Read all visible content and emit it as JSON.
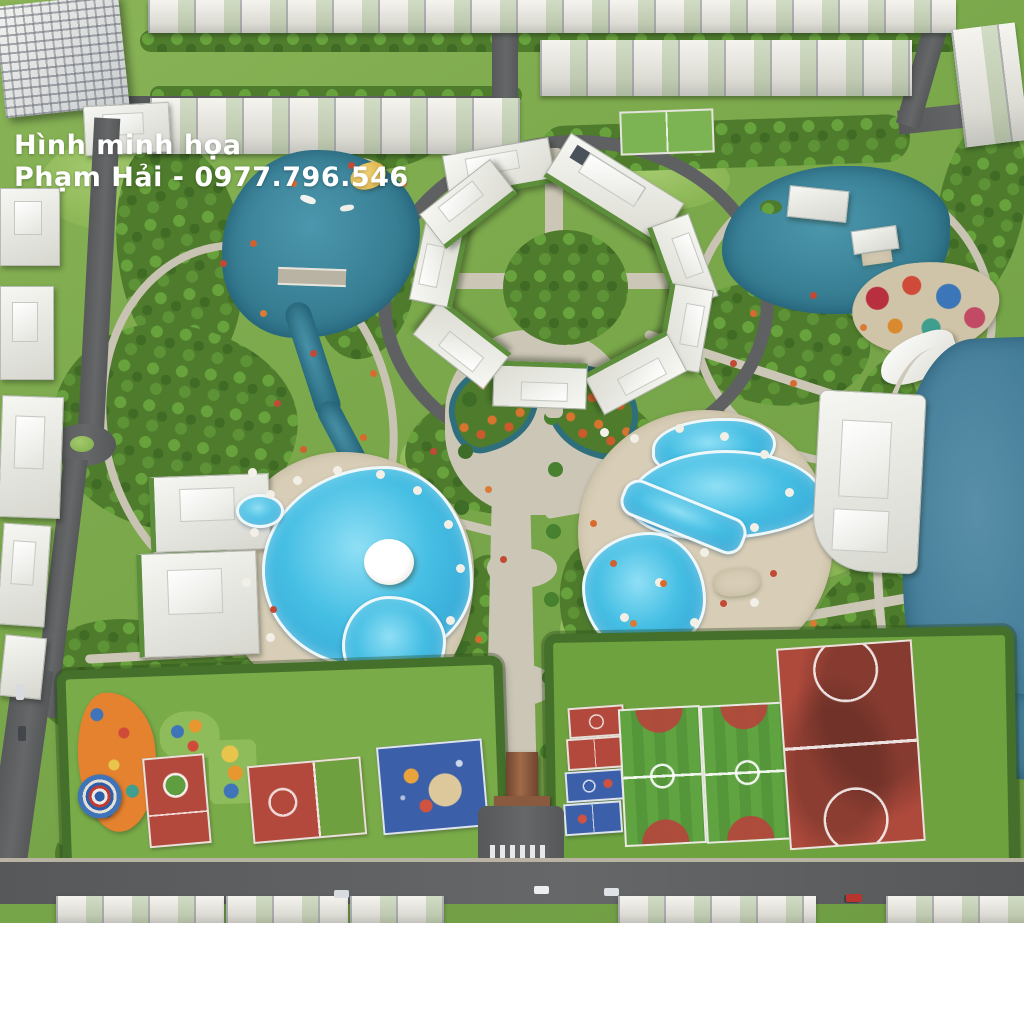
{
  "watermark": {
    "line1": "Hình minh họa",
    "line2": "Phạm Hải - 0977.796.546"
  },
  "palette": {
    "park_green": "#7aa84b",
    "forest_green": "#4e7c2c",
    "lawn_light": "#93bd5d",
    "lake_teal": "#35798f",
    "big_lake_blue": "#4a84a0",
    "pool_blue": "#46bfe4",
    "deck_tan": "#d8cdb6",
    "path_grey": "#ccc6b6",
    "road_asphalt": "#5a5c5e",
    "roof_white": "#e9e8e2",
    "court_red": "#b3483c",
    "court_blue": "#3b5fa9",
    "field_green": "#5aa03e",
    "playground_orange": "#e5822f",
    "canopy_yellow": "#ecc95e"
  }
}
